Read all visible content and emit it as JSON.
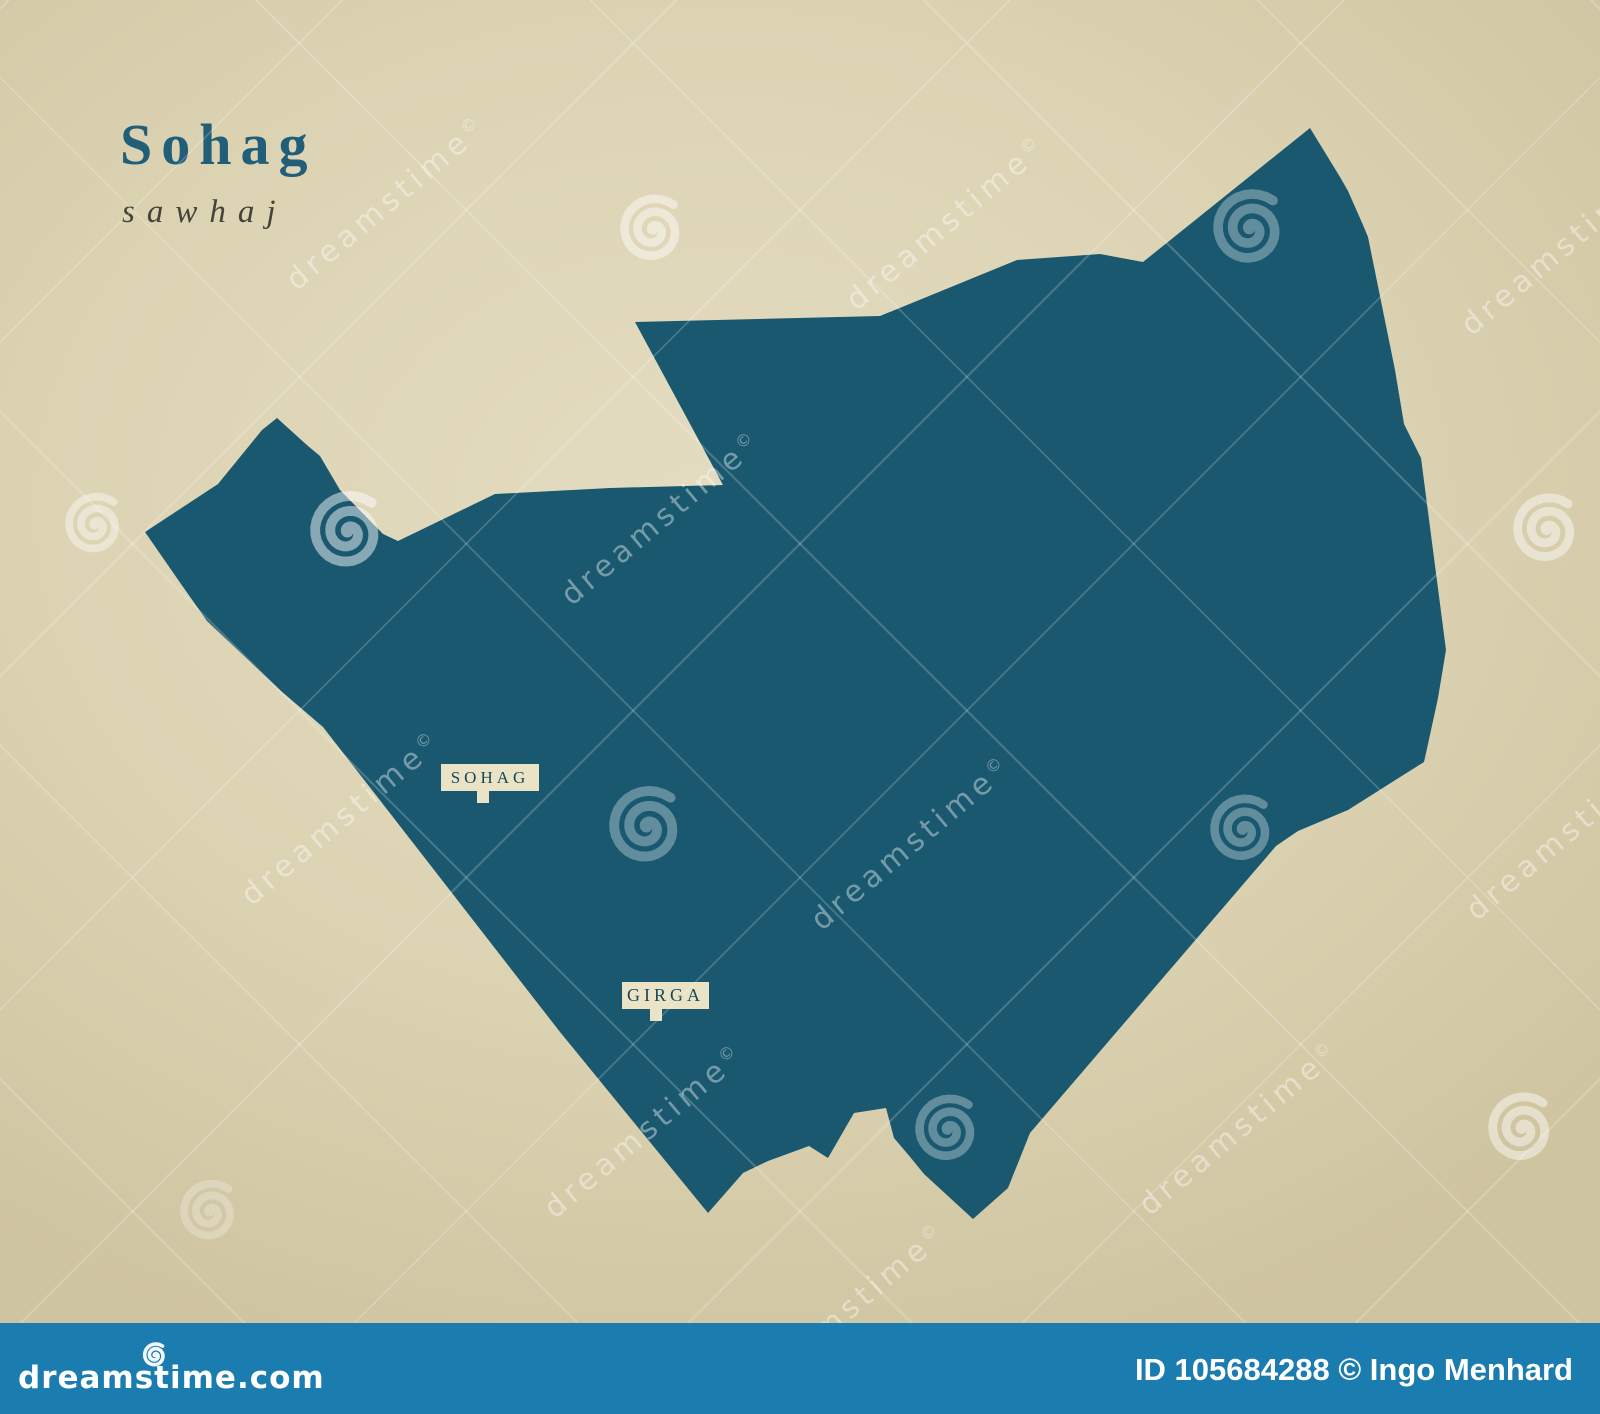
{
  "title": {
    "main": "Sohag",
    "subtitle": "sawhaj"
  },
  "map": {
    "fill": "#19586F",
    "points": "145,532 218,484 262,430 277,418 308,446 320,456 340,490 383,534 398,541 495,494 610,488 723,485 635,322 880,316 1017,260 1100,254 1143,262 1310,128 1340,177 1348,191 1363,225 1368,237 1395,370 1404,424 1421,458 1446,650 1438,698 1428,744 1424,762 1348,810 1298,831 1276,846 1030,1133 1008,1188 973,1219 924,1174 911,1158 894,1138 886,1108 854,1113 828,1158 809,1146 768,1161 743,1173 708,1213 560,1032 323,727 281,691 207,621 181,584"
  },
  "cities": [
    {
      "name": "SOHAG"
    },
    {
      "name": "GIRGA"
    }
  ],
  "background": {
    "base": "#dcd3b3",
    "light": "#e4dcc1",
    "dark": "#cfc4a0"
  },
  "watermark": {
    "text": "dreamstime",
    "copyright": "©",
    "bar": {
      "site": "dreamstime.com",
      "credit": "ID 105684288 © Ingo Menhard",
      "color": "#1b7cb0"
    },
    "text_instances": [
      {
        "x": 385,
        "y": 205
      },
      {
        "x": 945,
        "y": 225
      },
      {
        "x": 1560,
        "y": 250
      },
      {
        "x": 660,
        "y": 520
      },
      {
        "x": 340,
        "y": 820
      },
      {
        "x": 910,
        "y": 845
      },
      {
        "x": 1565,
        "y": 835
      },
      {
        "x": 643,
        "y": 1133
      },
      {
        "x": 1238,
        "y": 1130
      },
      {
        "x": 845,
        "y": 1312
      }
    ],
    "spirals": [
      {
        "x": 95,
        "y": 528,
        "r": 30,
        "o": 0.42
      },
      {
        "x": 348,
        "y": 535,
        "r": 38,
        "o": 0.48
      },
      {
        "x": 653,
        "y": 233,
        "r": 33,
        "o": 0.45
      },
      {
        "x": 1250,
        "y": 232,
        "r": 37,
        "o": 0.32
      },
      {
        "x": 1547,
        "y": 533,
        "r": 34,
        "o": 0.45
      },
      {
        "x": 647,
        "y": 830,
        "r": 38,
        "o": 0.32
      },
      {
        "x": 1243,
        "y": 833,
        "r": 33,
        "o": 0.32
      },
      {
        "x": 948,
        "y": 1133,
        "r": 33,
        "o": 0.32
      },
      {
        "x": 1522,
        "y": 1132,
        "r": 34,
        "o": 0.45
      },
      {
        "x": 210,
        "y": 1215,
        "r": 30,
        "o": 0.25
      }
    ]
  }
}
